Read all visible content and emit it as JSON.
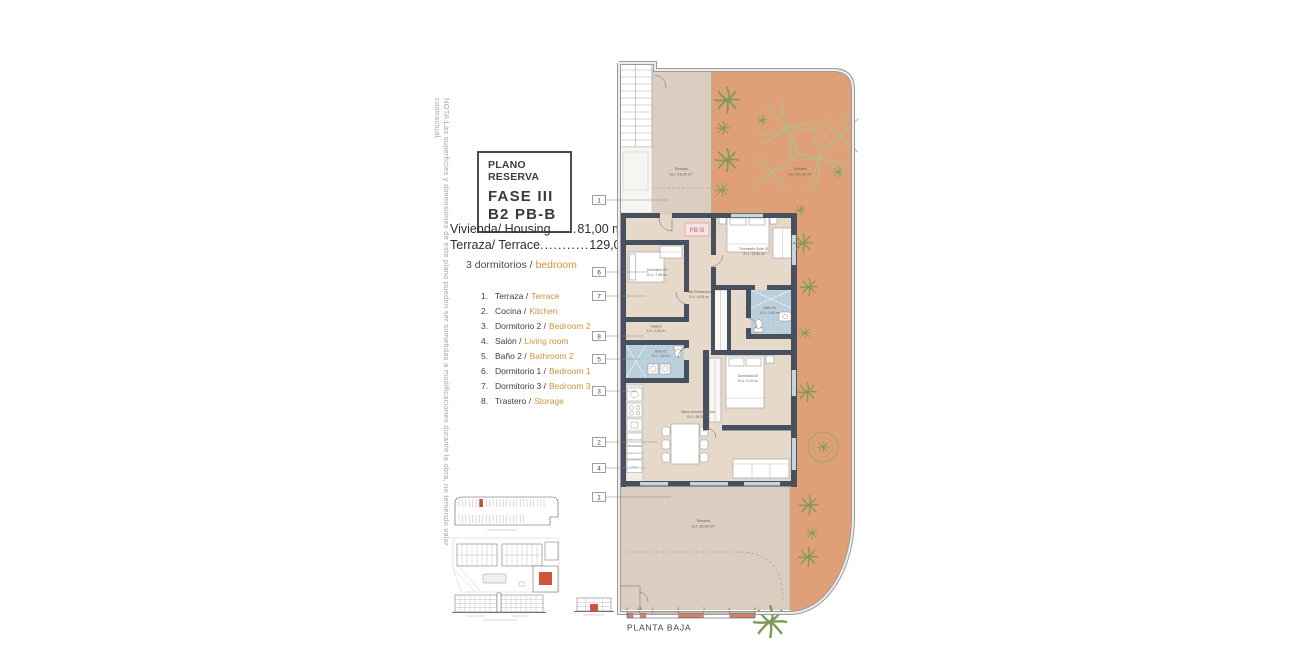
{
  "note": "NOTA:Las superficies y dimensiones de este plano pueden ser sometidas a modificaciones durante la obra, no teniendo valor contractual.",
  "title_box": {
    "kicker": "PLANO RESERVA",
    "phase": "FASE III",
    "unit": "B2 PB-B"
  },
  "areas": [
    {
      "label": "Vivienda/ Housing",
      "dots": "......",
      "value": "81,00 m²"
    },
    {
      "label": "Terraza/ Terrace",
      "dots": "...........",
      "value": "129,00 m²"
    }
  ],
  "bedrooms": {
    "es": "3 dormitorios /",
    "en": "bedroom"
  },
  "legend": [
    {
      "num": "1.",
      "es": "Terraza /",
      "en": "Terrace"
    },
    {
      "num": "2.",
      "es": "Cocina /",
      "en": "Kitchen"
    },
    {
      "num": "3.",
      "es": "Dormitorio 2 /",
      "en": "Bedroom 2"
    },
    {
      "num": "4.",
      "es": "Salón /",
      "en": "Living room"
    },
    {
      "num": "5.",
      "es": "Baño 2 /",
      "en": "Bathroom 2"
    },
    {
      "num": "6.",
      "es": "Dormitorio 1 /",
      "en": "Bedroom 1"
    },
    {
      "num": "7.",
      "es": "Dormitorio 3 /",
      "en": "Bedroom 3"
    },
    {
      "num": "8.",
      "es": "Trastero /",
      "en": "Storage"
    }
  ],
  "plan": {
    "unit_tag": "PB-B",
    "rooms": {
      "terraza_top": {
        "name": "Terraza",
        "area": "SU: 21,00 m²"
      },
      "terraza_right": {
        "name": "Terraza",
        "area": "SU: 82,00 m²"
      },
      "suite": {
        "name": "Dormitorio Suite 01",
        "area": "S.U.: 13,50 m²"
      },
      "dorm3": {
        "name": "Dormitorio 03",
        "area": "S.U.: 7,38 m²"
      },
      "hall": {
        "name": "Hall Distribuidor",
        "area": "S.U.: 6,00 m²"
      },
      "bath1": {
        "name": "Baño 01",
        "area": "S.U.: 3,40 m²"
      },
      "trastero": {
        "name": "Trastero",
        "area": "S.U.: 2,36 m²"
      },
      "bath2": {
        "name": "Baño 02",
        "area": "S.U.: 3,50 m²"
      },
      "dorm2": {
        "name": "Dormitorio 02",
        "area": "S.U.: 9,10 m²"
      },
      "salon": {
        "name": "Salón comedor-cocina",
        "area": "S.U.: 26,26 m²"
      },
      "terraza_bottom": {
        "name": "Terraza",
        "area": "SU: 30,00 m²"
      }
    },
    "markers": [
      "1",
      "6",
      "7",
      "8",
      "5",
      "3",
      "2",
      "4",
      "1"
    ],
    "kitchen": [
      "LAVA-VAJILLAS",
      "HORNO MICRO",
      "FRIGO"
    ]
  },
  "footer": {
    "plan_name": "PLANTA BAJA",
    "scale_ticks": [
      "0",
      "0.5",
      "1",
      "2",
      "3",
      "4",
      "5"
    ]
  },
  "colors": {
    "terrace_orange": "#e0a077",
    "room_beige": "#e7d9ca",
    "terrace_beige": "#dbcec1",
    "wall": "#46505e",
    "bath_blue": "#b9cedb",
    "accent_orange": "#cf9340",
    "pink": "#d885a5",
    "scale_salmon": "#c98570",
    "highlight_red": "#cc4a38",
    "palm_green": "#7f9a58"
  }
}
